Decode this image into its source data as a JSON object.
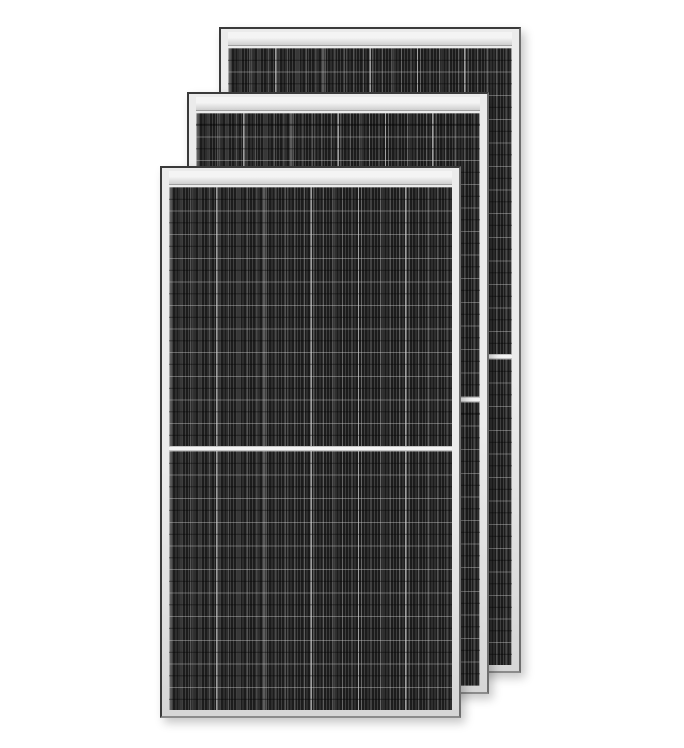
{
  "scene": {
    "description": "Three overlapping black monocrystalline half-cut solar panels with silver aluminum frames standing upright on a plain white background",
    "item_count": 3,
    "colors": {
      "background": "#ffffff",
      "frame_outline": "#3a3a3a",
      "frame_outline_right": "#6e6e6e",
      "frame_outline_bottom": "#8b8b8b",
      "frame_light": "#ebebeb",
      "frame_dark": "#d6d6d6",
      "header_top": "#f4f4f4",
      "header_bottom": "#cfcfcf",
      "header_line": "#9f9f9f",
      "cell_base": "#1c1c1c",
      "stripe_light": "#3f3f3f",
      "busbar_highlight": "rgba(165,165,165,0.40)",
      "grid_major": "rgba(180,180,180,0.85)",
      "grid_minor": "rgba(150,150,150,0.30)",
      "row_line": "rgba(215,215,215,0.38)",
      "row_line_dark": "rgba(0,0,0,0.45)",
      "divider_fill": "#f3f3f3",
      "divider_edge": "#c4c4c4",
      "shadow": "rgba(0,0,0,0.22)"
    },
    "structure": {
      "columns": 6,
      "column_pitch_px": 47.2,
      "row_pitch_px": 23.6,
      "stripe_period_px": 3.2,
      "busbar_pitch_px": 9.5,
      "divider_height_px": 5,
      "header_height_px": 13
    },
    "panels": [
      {
        "id": "back",
        "left": 219,
        "top": 27,
        "width": 302,
        "height": 646,
        "z": 1,
        "rows_per_half": 13
      },
      {
        "id": "middle",
        "left": 187,
        "top": 92,
        "width": 302,
        "height": 602,
        "z": 2,
        "rows_per_half": 12
      },
      {
        "id": "front",
        "left": 160,
        "top": 166,
        "width": 301,
        "height": 552,
        "z": 3,
        "rows_per_half": 11
      }
    ]
  }
}
